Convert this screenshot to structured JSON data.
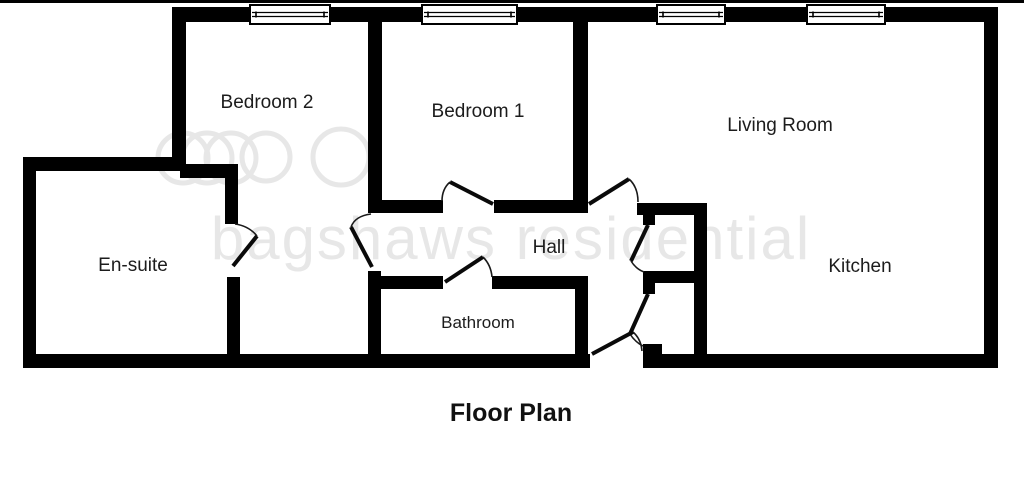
{
  "title": "Floor Plan",
  "watermark": {
    "text": "bagshaws residential"
  },
  "rooms": [
    {
      "label": "Bedroom 2"
    },
    {
      "label": "Bedroom 1"
    },
    {
      "label": "Living Room"
    },
    {
      "label": "En-suite"
    },
    {
      "label": "Hall"
    },
    {
      "label": "Bathroom"
    },
    {
      "label": "Kitchen"
    }
  ],
  "colors": {
    "wall": "#000000",
    "background": "#ffffff",
    "label": "#1c1c1c",
    "watermark": "#e7e7e7"
  }
}
